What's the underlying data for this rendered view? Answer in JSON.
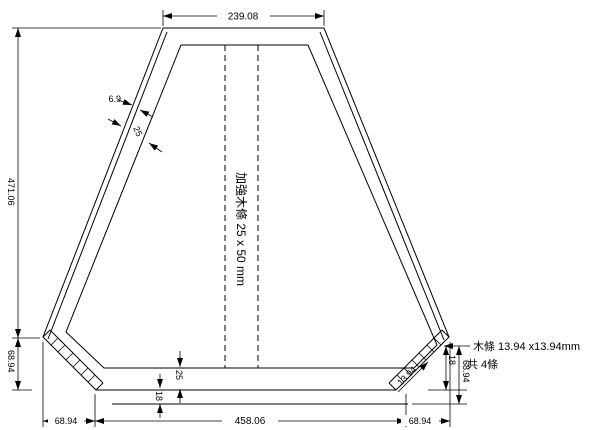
{
  "drawing": {
    "background": "#ffffff",
    "line_color": "#000000",
    "dims": {
      "top_width": "239.08",
      "total_height": "471.06",
      "left_chamfer_height": "68.94",
      "bottom_left_chamfer": "68.94",
      "bottom_width": "458.06",
      "bottom_right_chamfer": "68.94",
      "right_bottom_offset": "18",
      "right_chamfer_height": "68.94",
      "skin_thickness": "6.9",
      "slant_member_width": "25",
      "bottom_member_width": "25",
      "bottom_edge_offset": "18",
      "strip_diagonal": "13.94"
    },
    "notes": {
      "center": "加強木條 25 x 50 mm",
      "right_line1": "木條 13.94 x13.94mm",
      "right_line2": "共 4條"
    }
  }
}
